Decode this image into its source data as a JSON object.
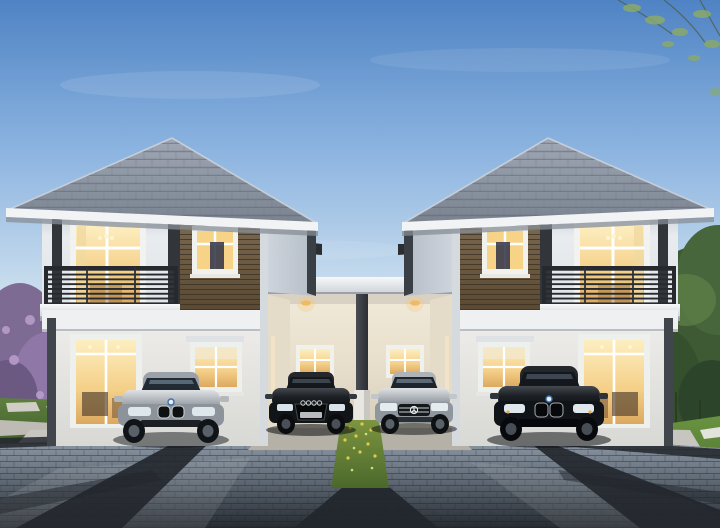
{
  "scene": {
    "title": "Architectural dusk rendering: twin two-storey houses joined by a shared carport, four sedans parked on a paver driveway",
    "objects": {
      "sky": "evening sky with soft clouds",
      "branches": "overhanging leafy branch, top right",
      "trees_right": "green garden trees, right side",
      "bush_left": "purple flowering bush, left side",
      "lawn_left": "left lawn with stepping stones",
      "lawn_right": "right lawn with stepping pads",
      "driveway": "grey paver driveway with dark accent bands",
      "grass_strip": "flowering grass strip in driveway center",
      "carport": "shared covered carport with warm downlights",
      "column": "central carport column",
      "house_left": "left two-storey house with balcony and wood feature wall",
      "house_right": "right two-storey house (mirrored)",
      "roof": "grey hipped tile roof",
      "balcony": "dark steel balcony railing",
      "wood_panel": "brown timber feature cladding",
      "windows": "warm-lit windows and glass doors",
      "car_silver_bmw": "silver sedan parked left",
      "car_black_audi": "black sedan in carport left bay",
      "car_silver_mercedes": "silver sedan in carport right bay",
      "car_black_bmw": "black sedan parked right"
    },
    "palette": {
      "sky_top": "#5d8fcc",
      "sky_mid": "#a9c8e8",
      "sky_horizon": "#efe9da",
      "sunset_glow": "#f6e3c8",
      "roof_tile": "#8b94a4",
      "fascia_white": "#f1f3f5",
      "wall_light": "#e9ecef",
      "wall_ground": "#e3e2de",
      "wood_panel": "#6e5b44",
      "trim_dark": "#32363b",
      "railing": "#26292d",
      "window_glow": "#f7d98e",
      "carport_wall": "#ece4d4",
      "downlight": "#f6c87e",
      "driveway_light": "#97a2b0",
      "driveway_dark": "#23282e",
      "lawn_green": "#567937",
      "bright_lawn": "#5f8838",
      "flower_purple": "#8f77a8",
      "tree_green": "#3d5a35",
      "car_silver": "#b9bcc0",
      "car_black": "#17191c"
    }
  }
}
